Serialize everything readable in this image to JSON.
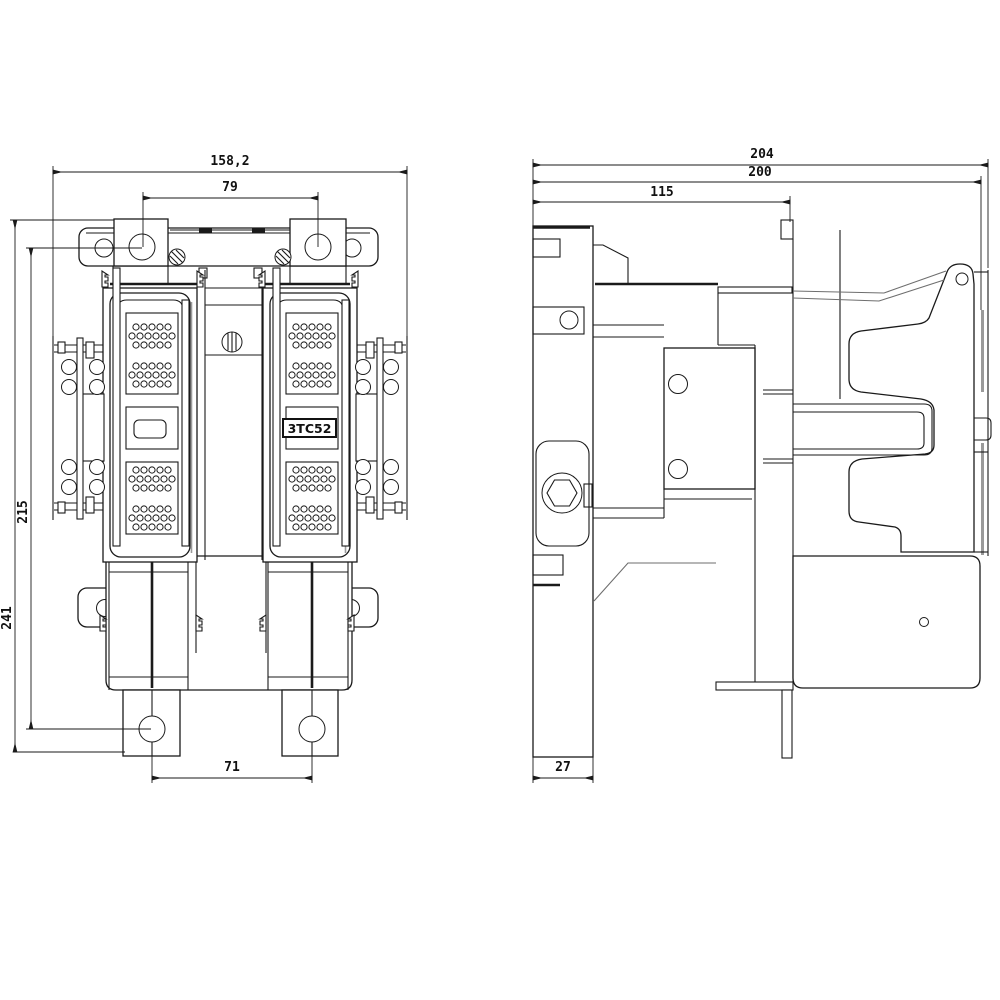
{
  "drawing": {
    "type": "technical-dimension-drawing",
    "product_label": "3TC52",
    "colors": {
      "line": "#1a1a1a",
      "gray": "#9a9a9a",
      "background": "#ffffff"
    },
    "front_view": {
      "dims": {
        "overall_width": "158,2",
        "top_hole_spacing": "79",
        "overall_height": "241",
        "mounting_hole_span": "215",
        "foot_hole_spacing": "71"
      }
    },
    "side_view": {
      "dims": {
        "overall_depth": "204",
        "body_depth": "200",
        "front_section_depth": "115",
        "rail_plate_depth": "27"
      }
    }
  }
}
